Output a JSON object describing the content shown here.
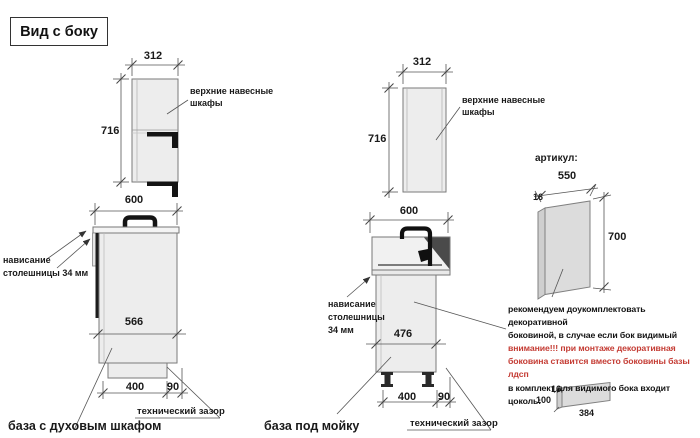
{
  "title": "Вид с боку",
  "colors": {
    "accent_red": "#c43b33",
    "cabinet_fill": "#ededed",
    "line": "#555555"
  },
  "left_section": {
    "upper_cabinet": {
      "width": "312",
      "height": "716",
      "label_line1": "верхние навесные",
      "label_line2": "шкафы"
    },
    "base_cabinet": {
      "width": "600",
      "inner_depth": "566",
      "plinth_depth": "400",
      "tech_gap": "90",
      "overhang_line1": "нависание",
      "overhang_line2": "столешницы 34 мм",
      "tech_gap_label": "технический зазор",
      "caption": "база с духовым шкафом"
    }
  },
  "middle_section": {
    "upper_cabinet": {
      "width": "312",
      "height": "716",
      "label_line1": "верхние навесные",
      "label_line2": "шкафы"
    },
    "base_cabinet": {
      "width": "600",
      "inner_depth": "476",
      "plinth_depth": "400",
      "tech_gap": "90",
      "overhang_line1": "нависание",
      "overhang_line2": "столешницы",
      "overhang_line3": "34 мм",
      "tech_gap_label": "технический зазор",
      "caption": "база под мойку"
    }
  },
  "right_section": {
    "article_label": "артикул:",
    "side_panel": {
      "width": "550",
      "thickness": "16",
      "height": "700"
    },
    "note": {
      "line1": "рекомендуем доукомплектовать декоративной",
      "line2": "боковиной, в случае если бок видимый",
      "line3": "внимание!!! при монтаже декоративная",
      "line4": "боковина ставится вместо боковины базы лдсп",
      "line5": "в комплект для видимого бока входит цоколь:"
    },
    "plinth_panel": {
      "thickness": "16",
      "height": "100",
      "length": "384"
    }
  }
}
